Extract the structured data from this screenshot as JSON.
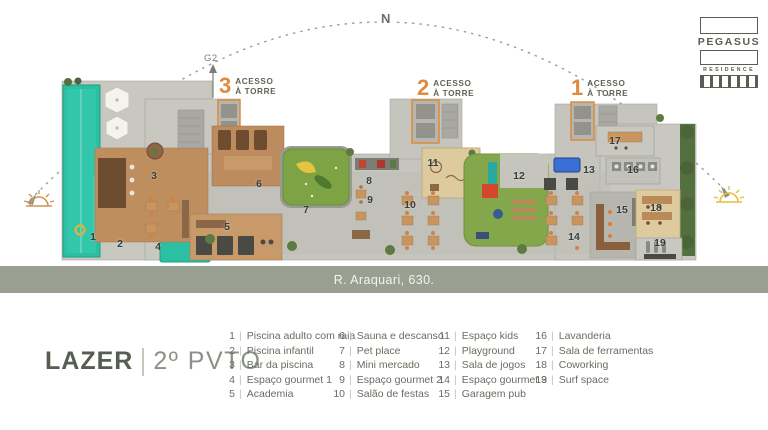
{
  "brand": {
    "name": "PEGASUS",
    "type": "RESIDENCE"
  },
  "compass": {
    "north": "N"
  },
  "map": {
    "g2": "G2",
    "street": "R. Araquari, 630."
  },
  "access_labels": [
    {
      "number": "3",
      "line1": "ACESSO",
      "line2": "À TORRE",
      "left": 219,
      "top": 75
    },
    {
      "number": "2",
      "line1": "ACESSO",
      "line2": "À TORRE",
      "left": 417,
      "top": 77
    },
    {
      "number": "1",
      "line1": "ACESSO",
      "line2": "À TORRE",
      "left": 571,
      "top": 77
    }
  ],
  "title": {
    "main": "LAZER",
    "sub": "2º PVTO"
  },
  "legend": {
    "columns": [
      {
        "left": 220,
        "items": [
          {
            "n": "1",
            "label": "Piscina adulto com raia"
          },
          {
            "n": "2",
            "label": "Piscina infantil"
          },
          {
            "n": "3",
            "label": "Bar da piscina"
          },
          {
            "n": "4",
            "label": "Espaço gourmet 1"
          },
          {
            "n": "5",
            "label": "Academia"
          }
        ]
      },
      {
        "left": 330,
        "items": [
          {
            "n": "6",
            "label": "Sauna e descanso"
          },
          {
            "n": "7",
            "label": "Pet place"
          },
          {
            "n": "8",
            "label": "Mini mercado"
          },
          {
            "n": "9",
            "label": "Espaço gourmet 2"
          },
          {
            "n": "10",
            "label": "Salão de festas"
          }
        ]
      },
      {
        "left": 435,
        "items": [
          {
            "n": "11",
            "label": "Espaço kids"
          },
          {
            "n": "12",
            "label": "Playground"
          },
          {
            "n": "13",
            "label": "Sala de jogos"
          },
          {
            "n": "14",
            "label": "Espaço gourmet 3"
          },
          {
            "n": "15",
            "label": "Garagem pub"
          }
        ]
      },
      {
        "left": 532,
        "items": [
          {
            "n": "16",
            "label": "Lavanderia"
          },
          {
            "n": "17",
            "label": "Sala de ferramentas"
          },
          {
            "n": "18",
            "label": "Coworking"
          },
          {
            "n": "19",
            "label": "Surf space"
          }
        ]
      }
    ]
  },
  "plan_markers": [
    {
      "n": "1",
      "x": 33,
      "y": 165
    },
    {
      "n": "2",
      "x": 60,
      "y": 172
    },
    {
      "n": "3",
      "x": 94,
      "y": 104
    },
    {
      "n": "4",
      "x": 98,
      "y": 175
    },
    {
      "n": "5",
      "x": 167,
      "y": 155
    },
    {
      "n": "6",
      "x": 199,
      "y": 112
    },
    {
      "n": "7",
      "x": 246,
      "y": 138
    },
    {
      "n": "8",
      "x": 309,
      "y": 109
    },
    {
      "n": "9",
      "x": 310,
      "y": 128
    },
    {
      "n": "10",
      "x": 350,
      "y": 133
    },
    {
      "n": "11",
      "x": 373,
      "y": 91
    },
    {
      "n": "12",
      "x": 459,
      "y": 104
    },
    {
      "n": "13",
      "x": 529,
      "y": 98
    },
    {
      "n": "14",
      "x": 514,
      "y": 165
    },
    {
      "n": "15",
      "x": 562,
      "y": 138
    },
    {
      "n": "16",
      "x": 573,
      "y": 98
    },
    {
      "n": "17",
      "x": 555,
      "y": 69
    },
    {
      "n": "18",
      "x": 596,
      "y": 136
    },
    {
      "n": "19",
      "x": 600,
      "y": 171
    }
  ],
  "colors": {
    "accent_orange": "#e08b3c",
    "pool_teal": "#2cc0a3",
    "street_band": "#9aa091",
    "text_dark": "#585e52",
    "turf_green": "#7da344"
  }
}
